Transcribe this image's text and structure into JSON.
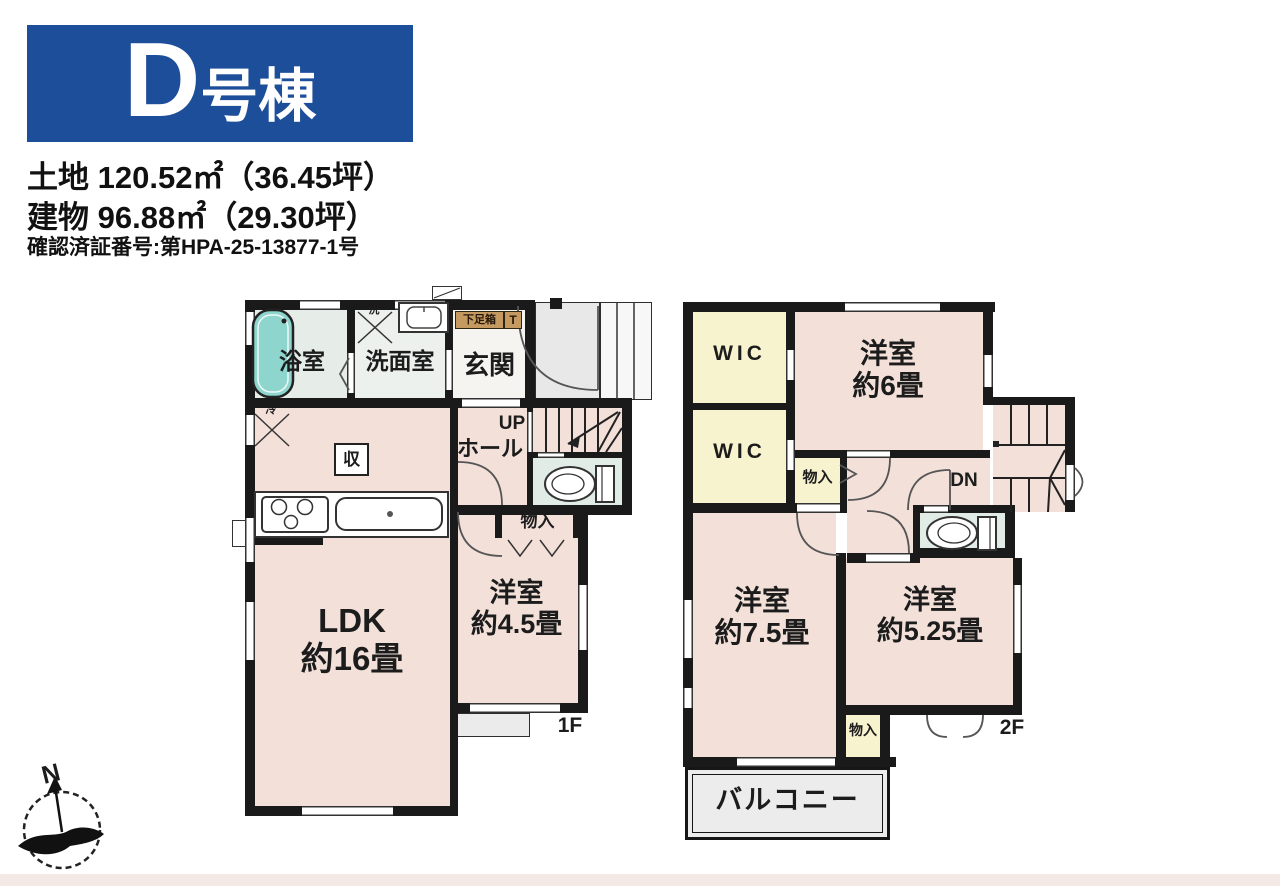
{
  "header": {
    "unit_letter": "D",
    "unit_suffix": "号棟",
    "land_line": "土地 120.52㎡（36.45坪）",
    "building_line": "建物 96.88㎡（29.30坪）",
    "confirmation_line": "確認済証番号:第HPA-25-13877-1号"
  },
  "floor1": {
    "floor_label": "1F",
    "bath_label": "浴室",
    "washroom_label": "洗面室",
    "entrance_label": "玄関",
    "shoe_cabinet_label": "下足箱",
    "shoe_cabinet_t": "T",
    "washer_label": "洗",
    "fridge_label": "冷",
    "storage_box_label": "収",
    "up_label": "UP",
    "hall_label": "ホール",
    "closet_label": "物入",
    "ldk_name": "LDK",
    "ldk_size": "約16畳",
    "western_room_name": "洋室",
    "western_room_size": "約4.5畳"
  },
  "floor2": {
    "floor_label": "2F",
    "wic1_label": "WIC",
    "wic2_label": "WIC",
    "room6_name": "洋室",
    "room6_size": "約6畳",
    "dn_label": "DN",
    "upper_closet_label": "物入",
    "room75_name": "洋室",
    "room75_size": "約7.5畳",
    "room525_name": "洋室",
    "room525_size": "約5.25畳",
    "lower_closet_label": "物入",
    "balcony_label": "バルコニー"
  },
  "compass": {
    "north_label": "N"
  },
  "colors": {
    "accent_blue": "#1d4e9a",
    "wall": "#1a1a1a",
    "room_pink": "#f2e0d9",
    "bath_green": "#e6ede9",
    "toilet_green": "#e2ece7",
    "closet_yellow": "#f8f3cf",
    "gray_area": "#e8e8e8",
    "tub_teal": "#8ed5cd",
    "shoe_tan": "#c49a61"
  }
}
